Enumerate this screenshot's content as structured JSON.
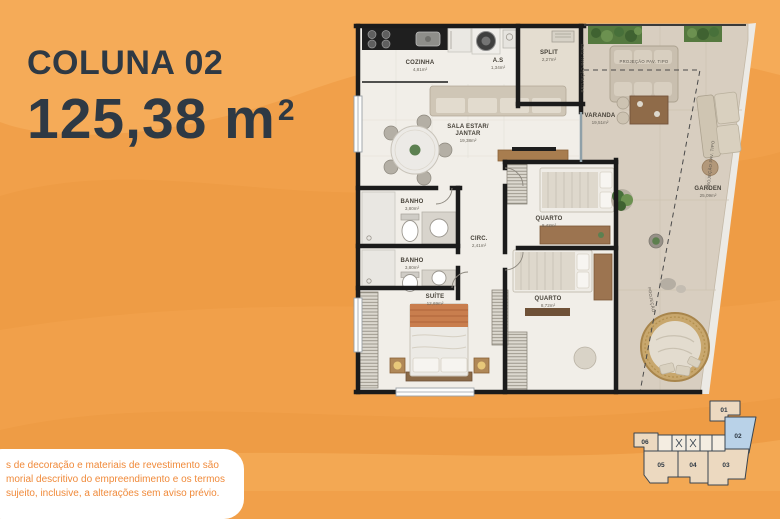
{
  "title": {
    "project_label": "COLUNA",
    "unit_number": "02",
    "area_value": "125,38 m",
    "area_exponent": "2"
  },
  "floor_plan": {
    "rooms": {
      "cozinha": {
        "name": "COZINHA",
        "area": "4,81m²"
      },
      "as": {
        "name": "A.S",
        "area": "1,34m²"
      },
      "split": {
        "name": "SPLIT",
        "area": "2,27m²"
      },
      "sala": {
        "line1": "SALA ESTAR/",
        "line2": "JANTAR",
        "area": "19,38m²"
      },
      "varanda": {
        "name": "VARANDA",
        "area": "19,51m²"
      },
      "garden": {
        "name": "GARDEN",
        "area": "25,09m²"
      },
      "banho_1": {
        "name": "BANHO",
        "area": "3,80m²"
      },
      "banho_2": {
        "name": "BANHO",
        "area": "3,80m²"
      },
      "circ": {
        "name": "CIRC.",
        "area": "2,41m²"
      },
      "quarto_1": {
        "name": "QUARTO",
        "area": "8,43m²"
      },
      "quarto_2": {
        "name": "QUARTO",
        "area": "8,72m²"
      },
      "suite": {
        "name": "SUÍTE",
        "area": "12,69m²"
      }
    },
    "annotations": {
      "projecao_vertical": "PROJEÇÃO PAV. TIPO",
      "projecao_horizontal": "PROJEÇÃO PAV. TIPO",
      "projecao_edge": "PROJEÇÃO PAV. TIPO",
      "projecao_diagonal": "PROJEÇÃO"
    }
  },
  "key_plan": {
    "units": [
      "01",
      "02",
      "03",
      "04",
      "05",
      "06"
    ],
    "highlighted_unit": "02"
  },
  "disclaimer": {
    "line1": "s de decoração e materiais de revestimento são",
    "line2": "morial descritivo do empreendimento e os termos",
    "line3": "sujeito, inclusive, a alterações sem aviso prévio."
  },
  "colors": {
    "background_orange": "#f1a04a",
    "title_text": "#2e3944",
    "highlight_blue": "#b9d2e8",
    "disclaimer_text": "#f08a3a",
    "wall_black": "#1b1b1b"
  }
}
